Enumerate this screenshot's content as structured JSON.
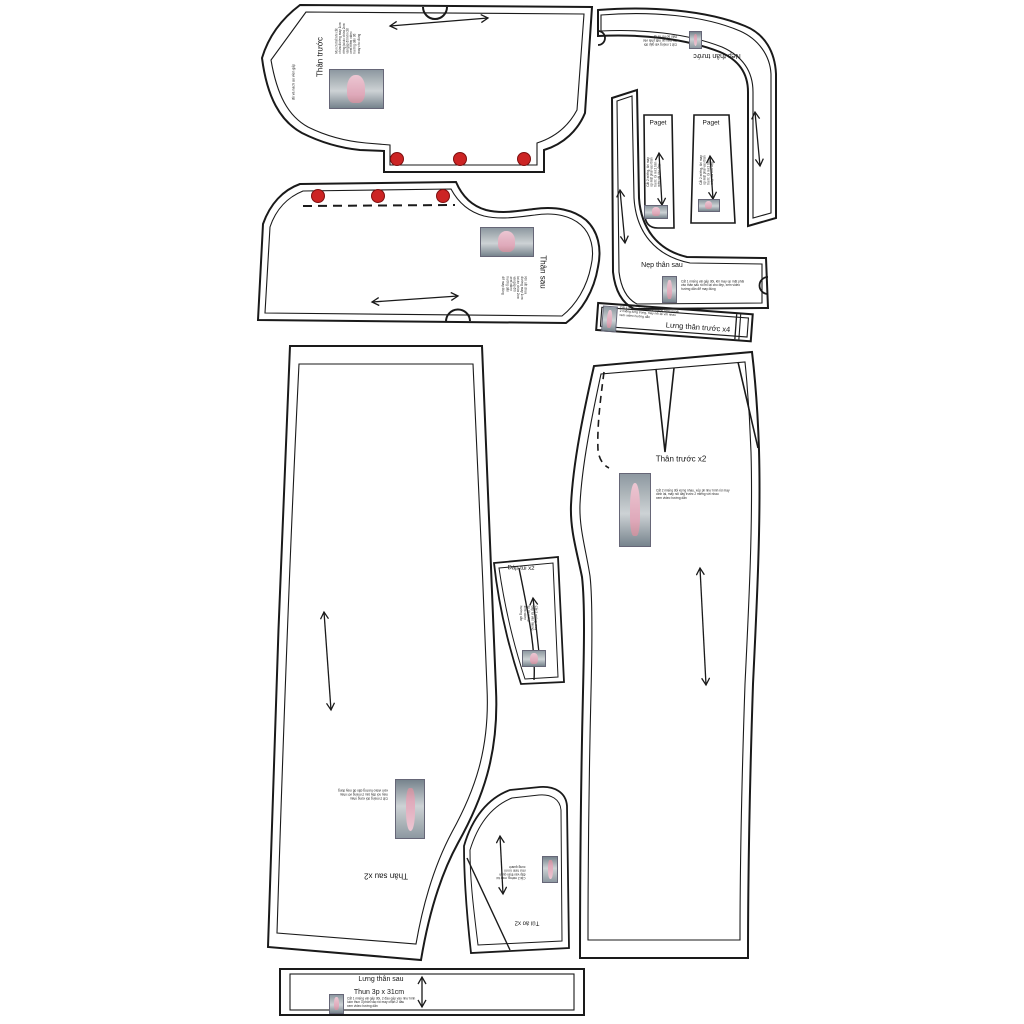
{
  "colors": {
    "outline": "#1a1a1a",
    "button_dot": "#cc2424",
    "button_dot_edge": "#7d1010",
    "paper": "#ffffff"
  },
  "pieces": {
    "shirt_front": {
      "label": "Thân trước",
      "side_note": "đồ và nách áo viền gấp",
      "note": "Mọi chi tiết khi cắt\nchừa đường may 1cm\nriêng lai áo chừa 2cm\nvải gấp đôi khi cắt\nxem thêm video\nhướng dẫn để\nmay cho đúng"
    },
    "shirt_back": {
      "label": "Thân sau",
      "note": "Khi cắt chừa\nđường may 1cm\nlai áo chừa 2cm\nvải gấp đôi\nxem video\nhướng dẫn\nđể may đúng"
    },
    "front_neck_facing": {
      "label": "Nẹp thân trước",
      "note": "Cắt 1 miếng vải gấp đôi\nkhi may úp mặt phải vào\nthân áo rồi mí lại"
    },
    "placket_left": {
      "label": "Paget",
      "note": "Cắt 2 miếng, khi may\núp mặt phải vào thân\ntrước rồi mí 2 bên\nmép vải cho đẹp"
    },
    "placket_right": {
      "label": "Paget",
      "note": "Cắt 2 miếng, khi may\núp mặt phải vào thân\ntrước rồi mí 2 bên\nmép vải cho đẹp"
    },
    "back_neck_facing": {
      "label": "Nẹp thân sau",
      "note": "Cắt 1 miếng vải gấp đôi, khi may úp mặt phải\nvào thân sau rồi mí lại cho đẹp, xem video\nhướng dẫn để may đúng"
    },
    "front_waistband": {
      "label": "Lưng thân trước x4",
      "note": "Cắt 4 miếng như hình, 2 miếng lưng ngoài\n2 miếng lưng trong, may nối lại với nhau\nxem video hướng dẫn"
    },
    "pants_front": {
      "label": "Thân trước x2",
      "note": "Cắt 2 miếng đối xứng nhau, xếp pli như hình rồi may\ndính lại, may nối đáy trước 2 miếng với nhau\nxem video hướng dẫn"
    },
    "pocket_facing": {
      "label": "Đáp túi x2",
      "note": "Cắt 2 miếng, may\nđáp túi vào miệng\ntúi rồi mí lại\nxem video\nhướng dẫn"
    },
    "pants_back": {
      "label": "Thân sau x2",
      "note": "Cắt 2 miếng đối xứng nhau\nmay nối đáy sau 2 miếng với nhau\nxem video hướng dẫn để may đúng"
    },
    "pocket": {
      "label": "Túi áo x2",
      "note": "Cắt 2 miếng, may túi\nđắp vào thân quần\nnhư hình rồi mí\nxung quanh"
    },
    "back_waistband": {
      "label": "Lưng thân sau",
      "sub_label": "Thun 3p x 31cm",
      "note": "Cắt 1 miếng vải gấp đôi, 2 đầu gấp vào như hình\nluồn thun 3 phân vào rồi may chặn 2 đầu\nxem video hướng dẫn"
    }
  }
}
